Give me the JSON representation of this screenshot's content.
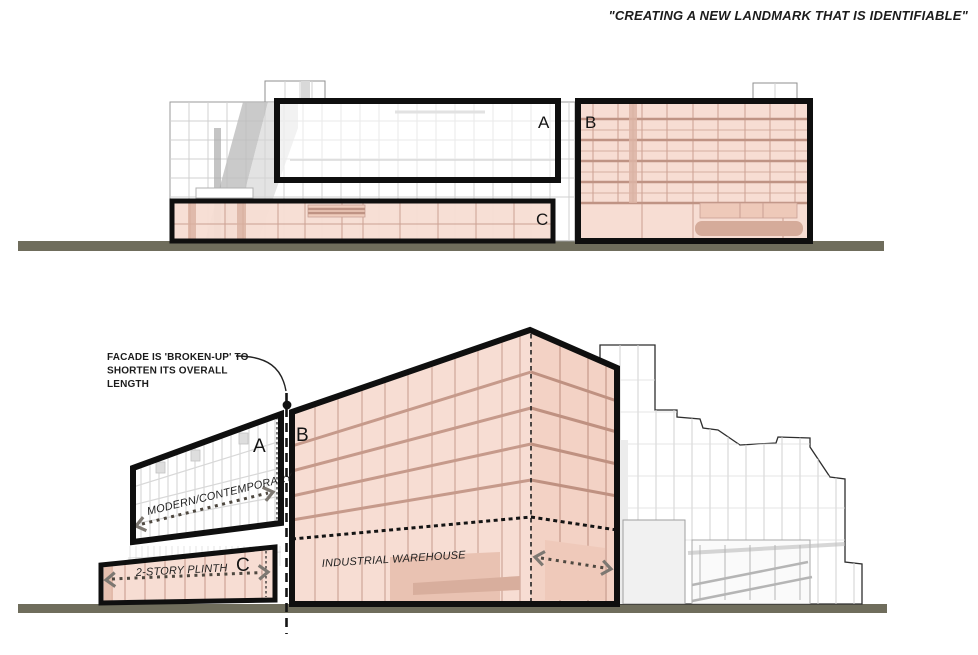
{
  "title": "\"CREATING A NEW LANDMARK THAT IS IDENTIFIABLE\"",
  "elevation": {
    "label_a": "A",
    "label_b": "B",
    "label_c": "C"
  },
  "perspective": {
    "label_a": "A",
    "label_b": "B",
    "label_c": "C",
    "annotation": {
      "line1": "FACADE IS 'BROKEN-UP' TO",
      "line2": "SHORTEN ITS OVERALL",
      "line3": "LENGTH"
    },
    "modern_contemporary": "MODERN/CONTEMPORARY",
    "two_story_plinth": "2-STORY PLINTH",
    "industrial_warehouse": "INDUSTRIAL WAREHOUSE"
  },
  "colors": {
    "massing_pink": "#f7ddd3",
    "massing_pink_line": "#cba092",
    "outline_black": "#0f0f0f",
    "ground_olive": "#6f6d5c",
    "context_gray": "#d0d0d0"
  }
}
